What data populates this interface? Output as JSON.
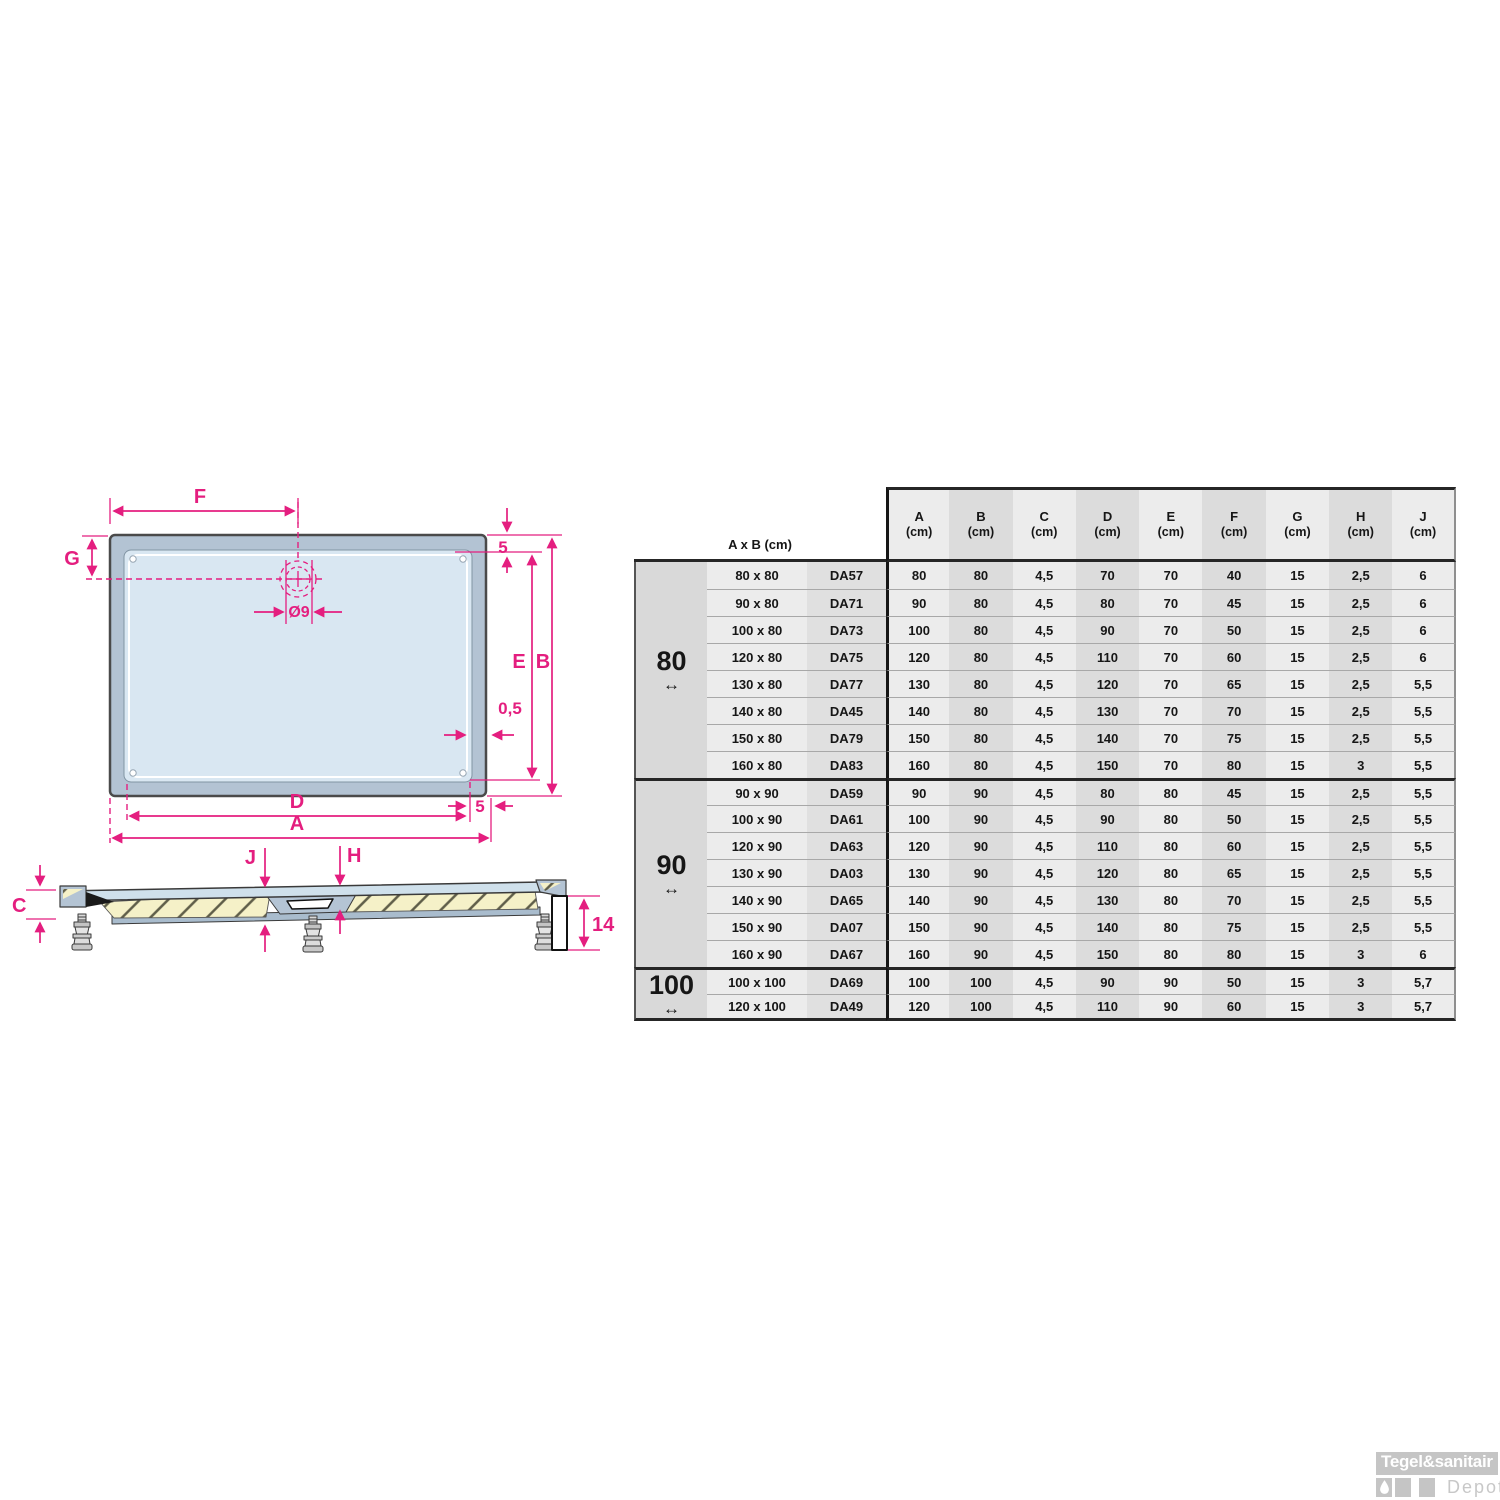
{
  "diagram": {
    "top_view": {
      "dim_f": "F",
      "dim_g": "G",
      "dim_rim_top": "5",
      "dim_e": "E",
      "dim_b": "B",
      "dim_edge": "0,5",
      "dim_drain": "Ø9",
      "dim_d": "D",
      "dim_a": "A",
      "dim_rim_bottom": "5"
    },
    "side_view": {
      "dim_c": "C",
      "dim_j": "J",
      "dim_h": "H",
      "dim_height": "14"
    }
  },
  "table": {
    "corner_label": "A x B (cm)",
    "unit": "(cm)",
    "columns": [
      "A",
      "B",
      "C",
      "D",
      "E",
      "F",
      "G",
      "H",
      "J"
    ],
    "groups": [
      {
        "label": "80",
        "arrow": "↔",
        "rows": [
          {
            "size": "80 x 80",
            "code": "DA57",
            "values": [
              "80",
              "80",
              "4,5",
              "70",
              "70",
              "40",
              "15",
              "2,5",
              "6"
            ]
          },
          {
            "size": "90 x 80",
            "code": "DA71",
            "values": [
              "90",
              "80",
              "4,5",
              "80",
              "70",
              "45",
              "15",
              "2,5",
              "6"
            ]
          },
          {
            "size": "100 x 80",
            "code": "DA73",
            "values": [
              "100",
              "80",
              "4,5",
              "90",
              "70",
              "50",
              "15",
              "2,5",
              "6"
            ]
          },
          {
            "size": "120 x 80",
            "code": "DA75",
            "values": [
              "120",
              "80",
              "4,5",
              "110",
              "70",
              "60",
              "15",
              "2,5",
              "6"
            ]
          },
          {
            "size": "130 x 80",
            "code": "DA77",
            "values": [
              "130",
              "80",
              "4,5",
              "120",
              "70",
              "65",
              "15",
              "2,5",
              "5,5"
            ]
          },
          {
            "size": "140 x 80",
            "code": "DA45",
            "values": [
              "140",
              "80",
              "4,5",
              "130",
              "70",
              "70",
              "15",
              "2,5",
              "5,5"
            ]
          },
          {
            "size": "150 x 80",
            "code": "DA79",
            "values": [
              "150",
              "80",
              "4,5",
              "140",
              "70",
              "75",
              "15",
              "2,5",
              "5,5"
            ]
          },
          {
            "size": "160 x 80",
            "code": "DA83",
            "values": [
              "160",
              "80",
              "4,5",
              "150",
              "70",
              "80",
              "15",
              "3",
              "5,5"
            ]
          }
        ]
      },
      {
        "label": "90",
        "arrow": "↔",
        "rows": [
          {
            "size": "90 x 90",
            "code": "DA59",
            "values": [
              "90",
              "90",
              "4,5",
              "80",
              "80",
              "45",
              "15",
              "2,5",
              "5,5"
            ]
          },
          {
            "size": "100 x 90",
            "code": "DA61",
            "values": [
              "100",
              "90",
              "4,5",
              "90",
              "80",
              "50",
              "15",
              "2,5",
              "5,5"
            ]
          },
          {
            "size": "120 x 90",
            "code": "DA63",
            "values": [
              "120",
              "90",
              "4,5",
              "110",
              "80",
              "60",
              "15",
              "2,5",
              "5,5"
            ]
          },
          {
            "size": "130 x 90",
            "code": "DA03",
            "values": [
              "130",
              "90",
              "4,5",
              "120",
              "80",
              "65",
              "15",
              "2,5",
              "5,5"
            ]
          },
          {
            "size": "140 x 90",
            "code": "DA65",
            "values": [
              "140",
              "90",
              "4,5",
              "130",
              "80",
              "70",
              "15",
              "2,5",
              "5,5"
            ]
          },
          {
            "size": "150 x 90",
            "code": "DA07",
            "values": [
              "150",
              "90",
              "4,5",
              "140",
              "80",
              "75",
              "15",
              "2,5",
              "5,5"
            ]
          },
          {
            "size": "160 x 90",
            "code": "DA67",
            "values": [
              "160",
              "90",
              "4,5",
              "150",
              "80",
              "80",
              "15",
              "3",
              "6"
            ]
          }
        ]
      },
      {
        "label": "100",
        "arrow": "↔",
        "rows": [
          {
            "size": "100 x 100",
            "code": "DA69",
            "values": [
              "100",
              "100",
              "4,5",
              "90",
              "90",
              "50",
              "15",
              "3",
              "5,7"
            ]
          },
          {
            "size": "120 x 100",
            "code": "DA49",
            "values": [
              "120",
              "100",
              "4,5",
              "110",
              "90",
              "60",
              "15",
              "3",
              "5,7"
            ]
          }
        ]
      }
    ]
  },
  "watermark": {
    "brand": "Tegel&sanitair",
    "sub": "Depot"
  },
  "colors": {
    "accent": "#e41e7f",
    "tray_rim": "#b3c3d3",
    "tray_surface": "#d9e7f2",
    "hatch_fill": "#f5f1c8",
    "table_light": "#ececec",
    "table_dark": "#dcdcdc",
    "group_bg": "#d9d9d9",
    "watermark_gray": "#c5c5c5"
  }
}
